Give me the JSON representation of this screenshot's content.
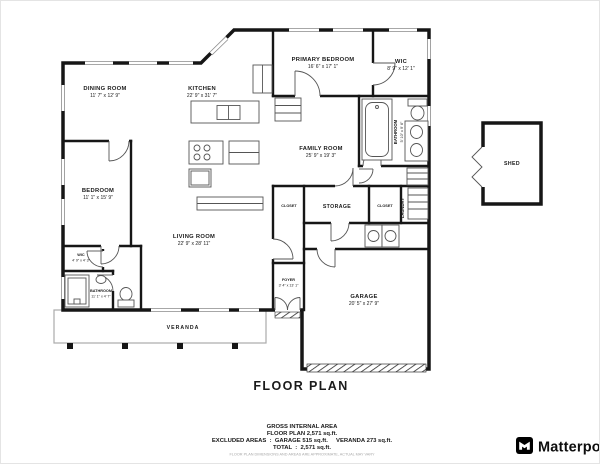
{
  "title": "FLOOR PLAN",
  "rooms": {
    "dining": {
      "name": "DINING ROOM",
      "dims": "11' 7\" x 12' 9\""
    },
    "kitchen": {
      "name": "KITCHEN",
      "dims": "22' 9\" x 31' 7\""
    },
    "primary_bedroom": {
      "name": "PRIMARY BEDROOM",
      "dims": "16' 6\" x 17' 1\""
    },
    "primary_wic": {
      "name": "WIC",
      "dims": "8' 9\" x 12' 1\""
    },
    "family_room": {
      "name": "FAMILY ROOM",
      "dims": "25' 9\" x 19' 3\""
    },
    "primary_bathroom": {
      "name": "BATHROOM",
      "dims": "5' 10\" x 9' 6\""
    },
    "bedroom": {
      "name": "BEDROOM",
      "dims": "11' 1\" x 15' 9\""
    },
    "living_room": {
      "name": "LIVING ROOM",
      "dims": "22' 9\" x 28' 11\""
    },
    "storage": {
      "name": "STORAGE"
    },
    "closet_left": {
      "name": "CLOSET"
    },
    "closet_right": {
      "name": "CLOSET"
    },
    "laundry": {
      "name": "LAUNDRY"
    },
    "foyer": {
      "name": "FOYER",
      "dims": "3' 4\" x 13' 1\""
    },
    "wic_small": {
      "name": "WIC",
      "dims": "4' 9\" x 4' 3\""
    },
    "bathroom_small": {
      "name": "BATHROOM",
      "dims": "11' 1\" x 4' 7\""
    },
    "garage": {
      "name": "GARAGE",
      "dims": "20' 5\" x 27' 9\""
    },
    "shed": {
      "name": "SHED"
    },
    "veranda": {
      "name": "VERANDA"
    }
  },
  "summary": {
    "heading": "GROSS INTERNAL AREA",
    "floor_plan_line": "FLOOR PLAN 2,571 sq.ft.",
    "excluded_line": "EXCLUDED AREAS  :  GARAGE 515 sq.ft.     VERANDA 273 sq.ft.",
    "total_line": "TOTAL  :  2,571 sq.ft.",
    "disclaimer": "FLOOR PLAN DIMENSIONS AND AREAS ARE APPROXIMATE, ACTUAL MAY VARY"
  },
  "branding": {
    "name": "Matterport"
  },
  "colors": {
    "wall": "#161616",
    "line": "#555555",
    "window": "#8a8a8a",
    "logo": "#000000"
  }
}
